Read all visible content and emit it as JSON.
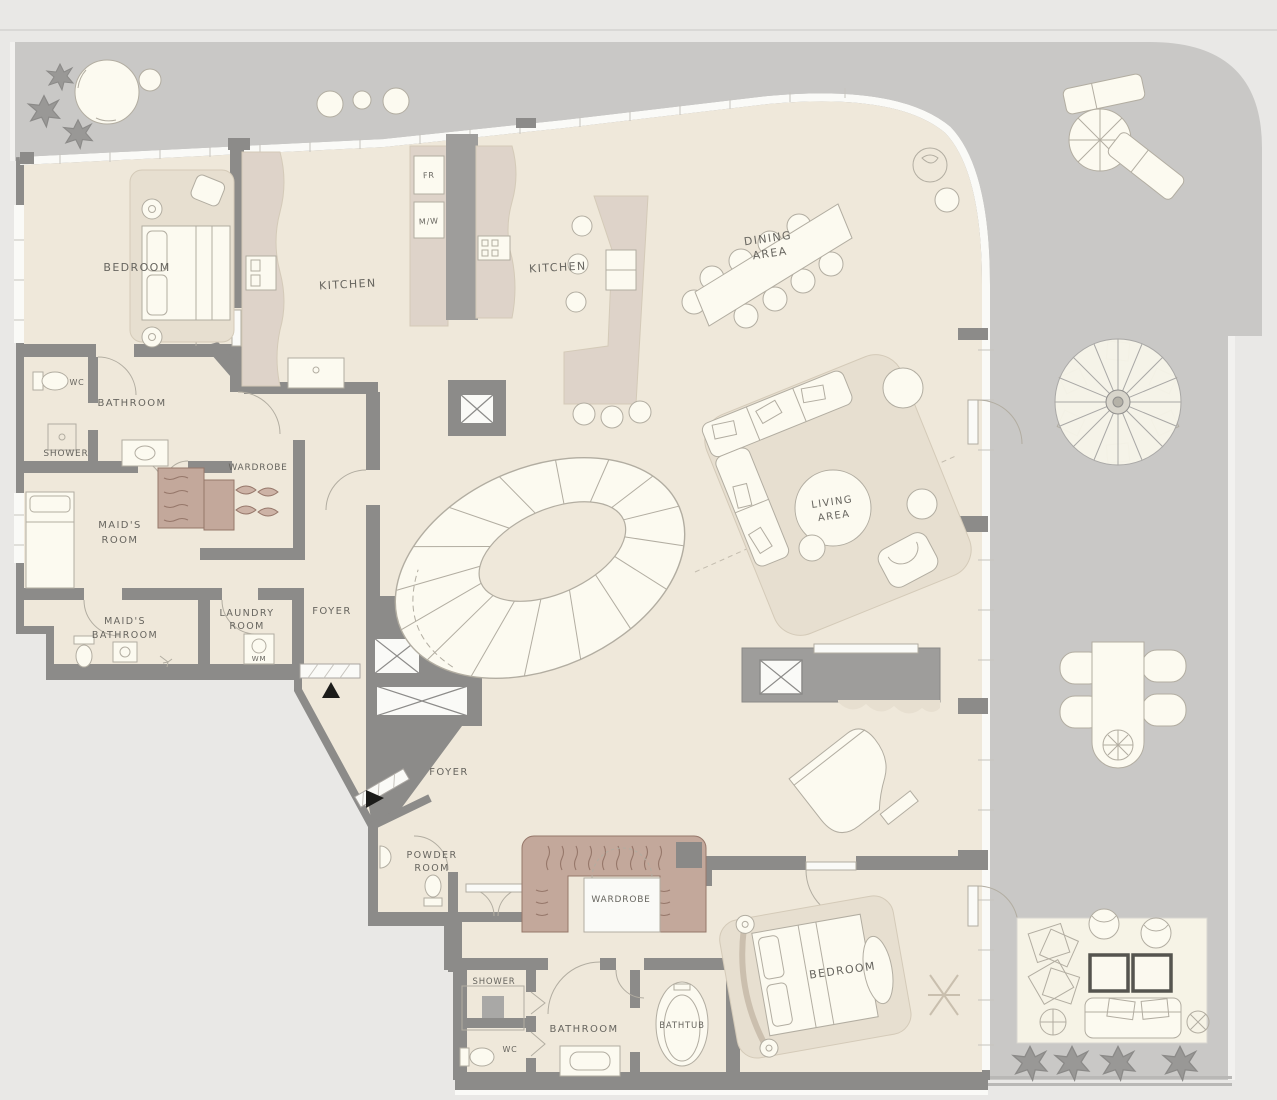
{
  "plan": {
    "type": "apartment-floor-plan",
    "rooms": {
      "bedroom_top": {
        "label": "BEDROOM"
      },
      "kitchen_left": {
        "label": "KITCHEN"
      },
      "kitchen_right": {
        "label": "KITCHEN"
      },
      "dining": {
        "lines": [
          "DINING",
          "AREA"
        ]
      },
      "wc_top": {
        "label": "WC"
      },
      "bathroom_top": {
        "label": "BATHROOM"
      },
      "shower_top": {
        "label": "SHOWER"
      },
      "wardrobe_top": {
        "label": "WARDROBE"
      },
      "maids_room": {
        "lines": [
          "MAID'S",
          "ROOM"
        ]
      },
      "maids_bathroom": {
        "lines": [
          "MAID'S",
          "BATHROOM"
        ]
      },
      "laundry_room": {
        "lines": [
          "LAUNDRY",
          "ROOM"
        ]
      },
      "foyer_upper": {
        "label": "FOYER"
      },
      "foyer_lower": {
        "label": "FOYER"
      },
      "living_area": {
        "lines": [
          "LIVING",
          "AREA"
        ]
      },
      "powder_room": {
        "lines": [
          "POWDER",
          "ROOM"
        ]
      },
      "wardrobe_bottom": {
        "label": "WARDROBE"
      },
      "bedroom_bottom": {
        "label": "BEDROOM"
      },
      "shower_bottom": {
        "label": "SHOWER"
      },
      "wc_bottom": {
        "label": "WC"
      },
      "bathroom_bottom": {
        "label": "BATHROOM"
      },
      "bathtub": {
        "label": "BATHTUB"
      }
    },
    "appliances": {
      "fridge": "FR",
      "microwave": "M/W",
      "washing_machine": "WM"
    }
  },
  "colors": {
    "bg": "#e9e8e6",
    "terrace": "#c9c8c6",
    "floor": "#efe8da",
    "wall": "#8c8b89",
    "furn": "#fcfaf0",
    "line": "#b2ada1",
    "beige": "#e7dfd0",
    "beigeline": "#d4cab8",
    "brown": "#c3a89b",
    "brownline": "#96776a",
    "counter": "#ded3c9",
    "darkunit": "#9e9d9b",
    "glass": "#fafaf7",
    "label": "#67655f",
    "plant": "#999896",
    "framedark": "#55544f"
  }
}
